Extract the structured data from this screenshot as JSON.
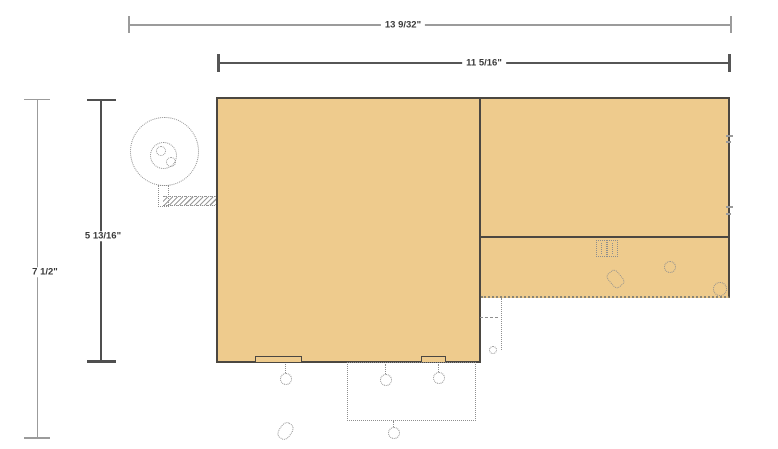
{
  "dimensions": {
    "overall_width": "13 9/32\"",
    "table_width": "11 5/16\"",
    "overall_height": "7 1/2\"",
    "table_height": "5 13/16\""
  },
  "colors": {
    "background": "#ffffff",
    "panel_fill": "#eecb8d",
    "panel_border": "#4b4741",
    "dim_line_light": "#9b9b9b",
    "dim_line_dark": "#565656",
    "dim_text": "#3a3a3a",
    "hidden_outline": "#8e8e8e"
  }
}
